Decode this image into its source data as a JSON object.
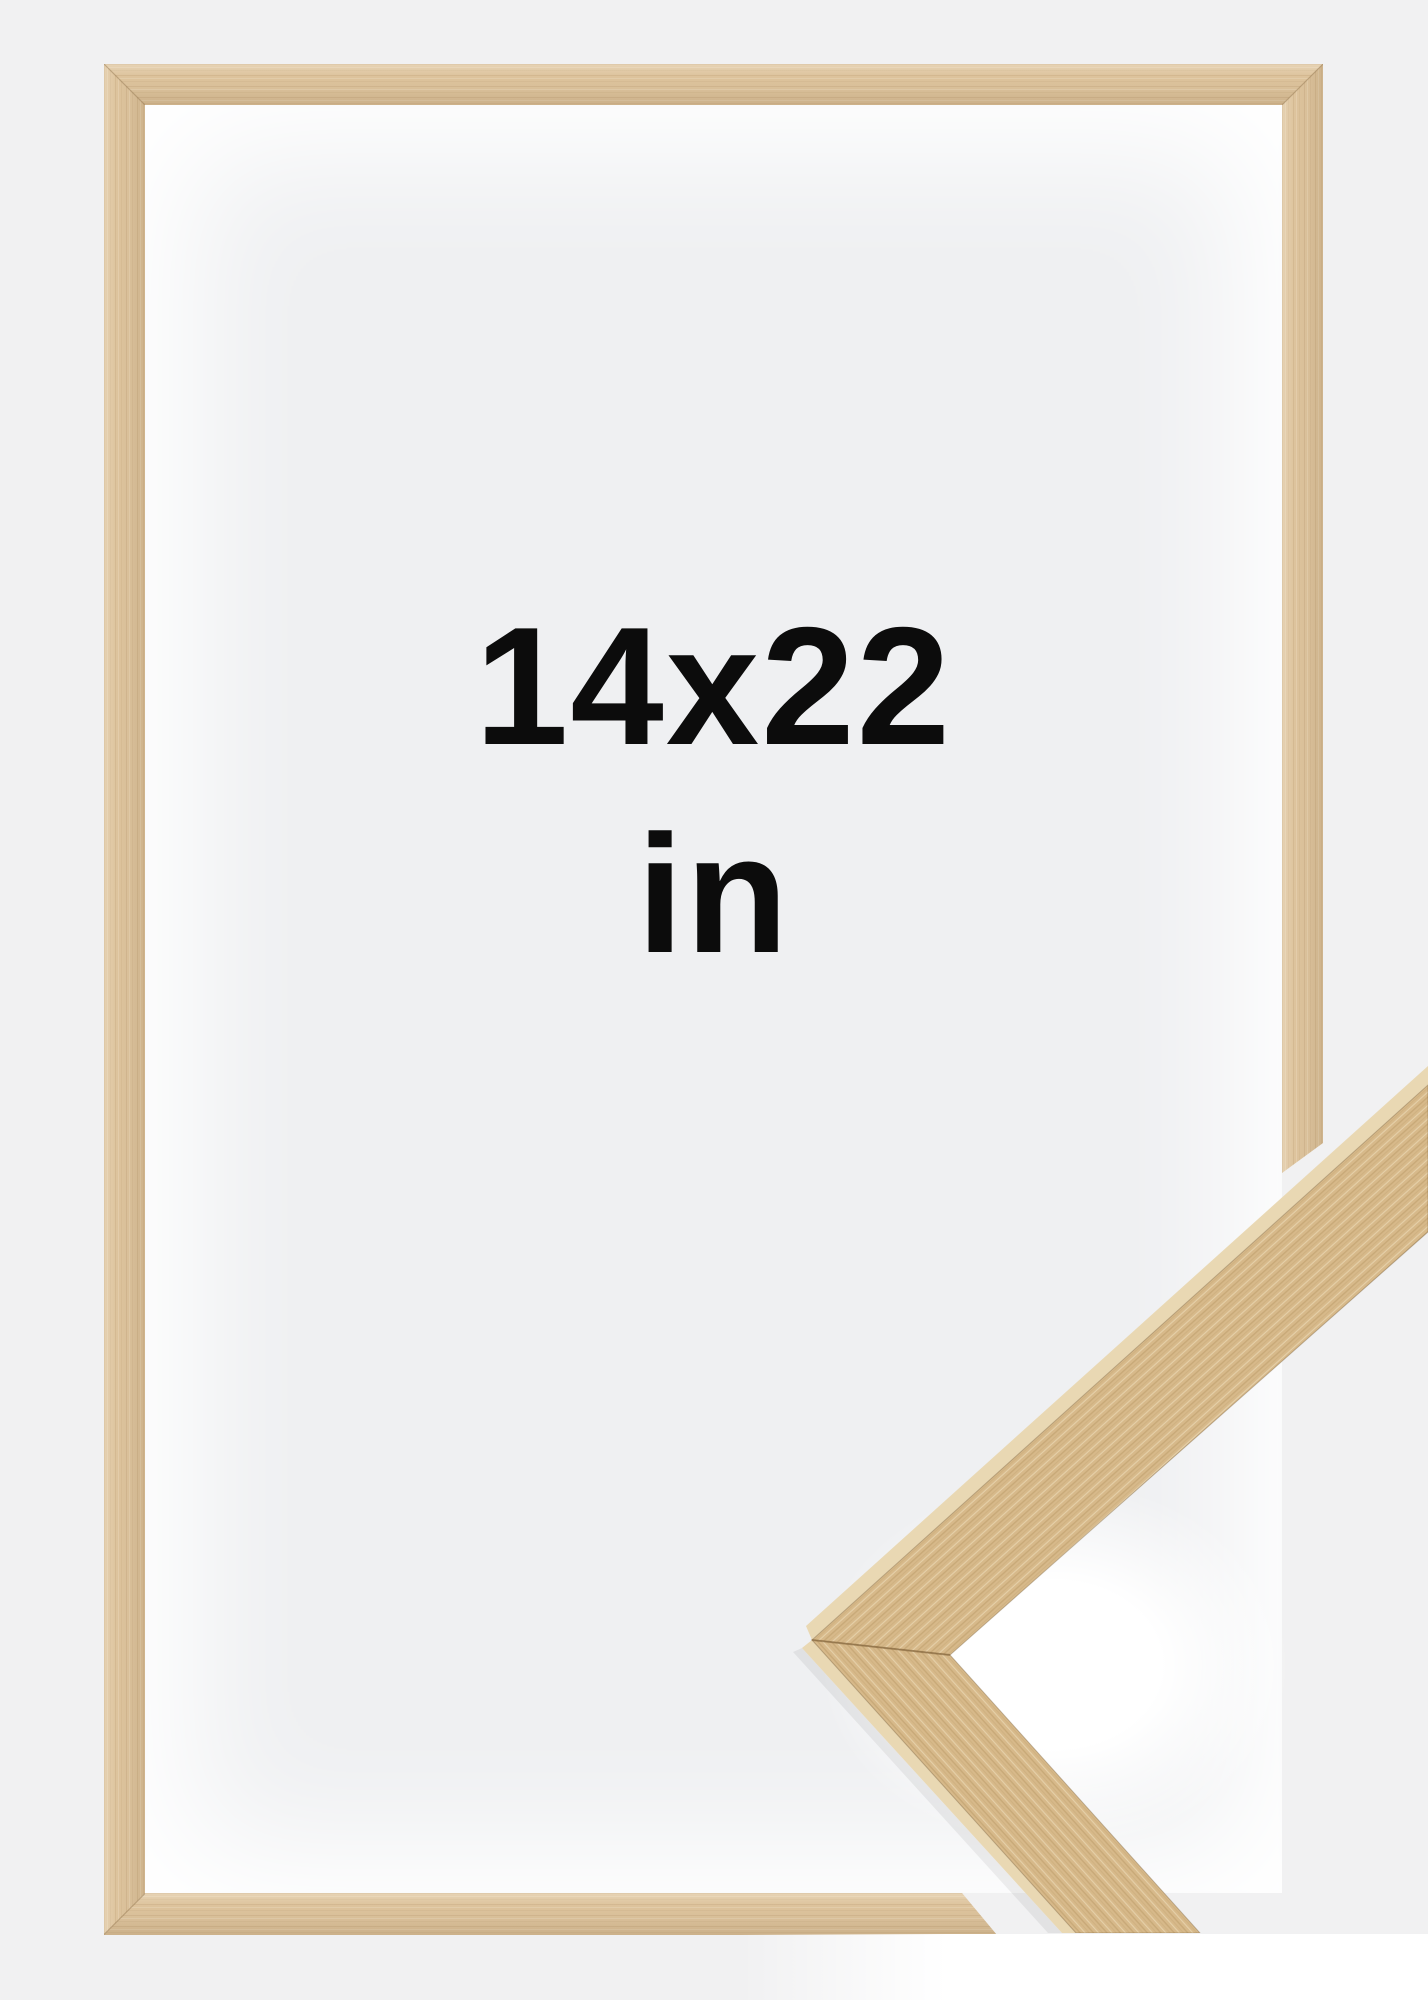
{
  "description": "Product photo of an empty natural oak picture frame on a light grey background with an enlarged close-up of the frame moulding corner overlaid in the lower-right",
  "size_label": {
    "line1": "14x22",
    "line2": "in"
  },
  "colors": {
    "bg": "#f1f1f2",
    "interior": "#eff0f2",
    "wood": "#ddc39c",
    "chevron_face": "#d7b98a",
    "chevron_side": "#e9d8b3",
    "grain_dark": "#a8854f",
    "grain_light": "#f0e3c2",
    "seam": "#8a6a3f",
    "text": "#0c0c0c",
    "white": "#ffffff"
  }
}
